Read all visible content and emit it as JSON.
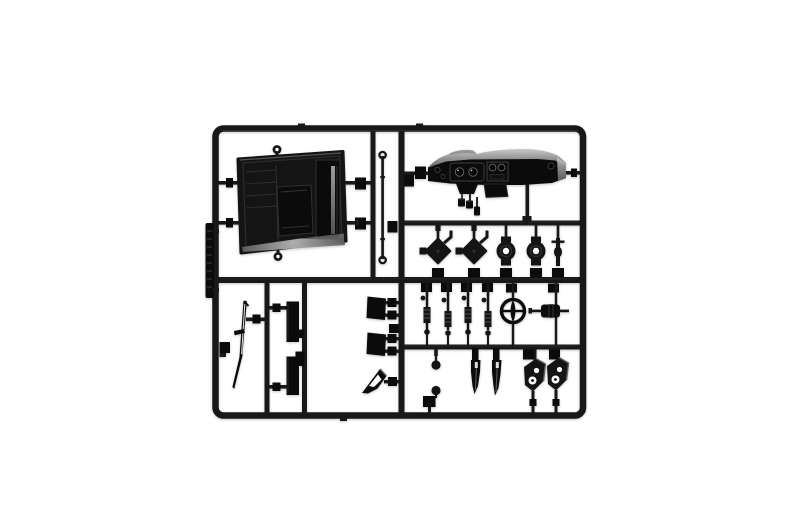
{
  "scene": {
    "kind": "photograph",
    "subject": "black plastic model kit sprue on white background"
  },
  "colors": {
    "background": "#ffffff",
    "frame": "#181818",
    "plastic": "#141414",
    "plastic_deep": "#0b0b0b",
    "detail_line": "#2f2f2f",
    "edge_light": "#3e3e3e",
    "metal_gray": "#8f8f8f",
    "soft_gray": "#5f5f5f",
    "spring_line": "#4f4f4f",
    "dash_top_light": "#c9c9c9",
    "dash_top_dark": "#636363",
    "step_light": "#b5b5b5",
    "step_dark": "#5e5e5e",
    "white": "#ffffff"
  },
  "parts": [
    "interior-tub",
    "linkage-rod",
    "dashboard",
    "pedals",
    "brake-hub",
    "brake-hub",
    "drum-pulley",
    "drum-pulley",
    "small-link",
    "shock-absorber",
    "shock-absorber",
    "shock-absorber",
    "shock-absorber",
    "steering-wheel",
    "axle-spindle",
    "gear-knob",
    "gear-knob",
    "lever-blade",
    "lever-blade",
    "hinge-bracket",
    "hinge-bracket",
    "wiper-blade",
    "side-plate",
    "side-plate",
    "mount-plate",
    "mount-plate",
    "corner-gusset",
    "sprue-id-tag"
  ]
}
